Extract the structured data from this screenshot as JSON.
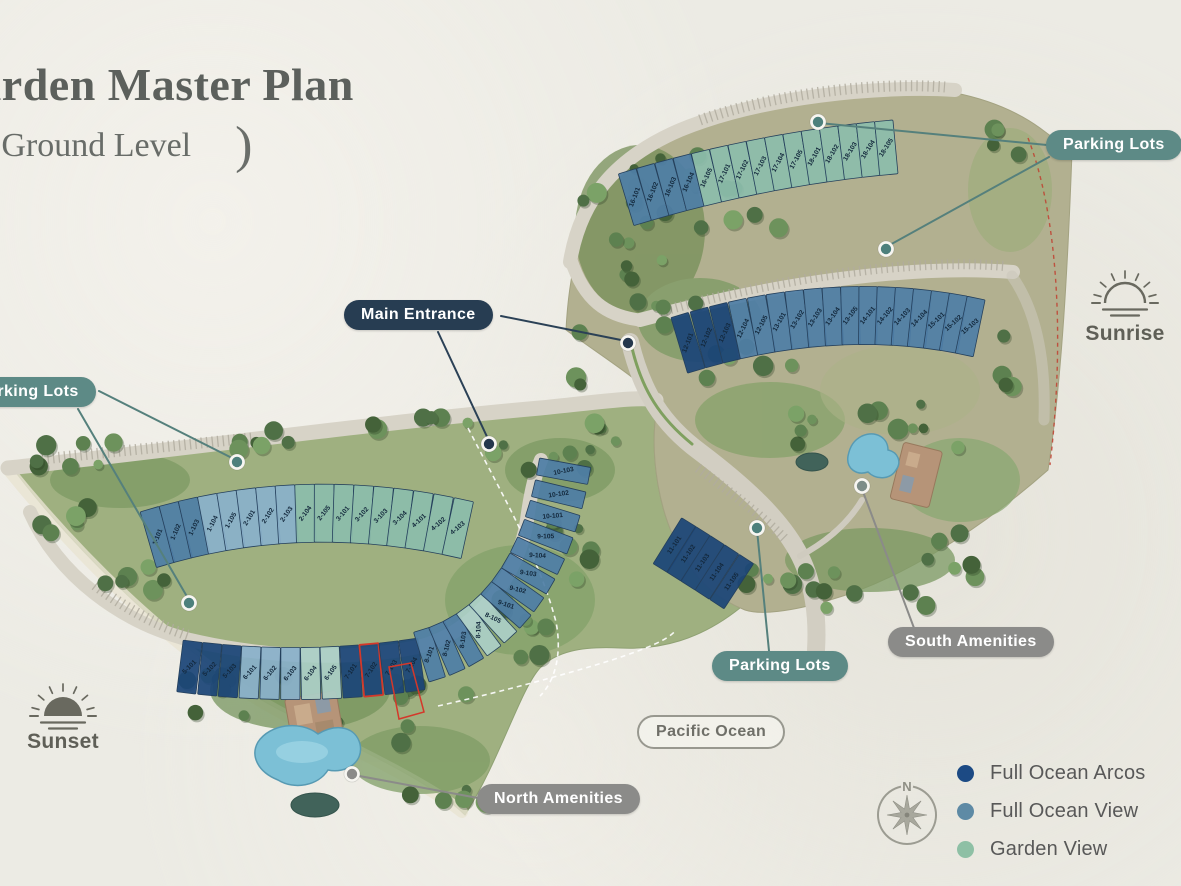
{
  "title": "Garden Master Plan",
  "subtitle": {
    "open": "(",
    "text": "Ground Level",
    "close": ")"
  },
  "callouts": {
    "main_entrance": "Main Entrance",
    "parking_lots": "Parking Lots",
    "south_amenities": "South Amenities",
    "north_amenities": "North Amenities",
    "pacific_ocean": "Pacific Ocean"
  },
  "directions": {
    "sunrise": "Sunrise",
    "sunset": "Sunset",
    "compass_north": "N"
  },
  "legend": {
    "items": [
      {
        "label": "Full Ocean Arcos",
        "category": "arcos"
      },
      {
        "label": "Full Ocean View",
        "category": "view"
      },
      {
        "label": "Garden View",
        "category": "garden"
      }
    ]
  },
  "colors": {
    "arcos": "#1b4577",
    "view": "#4f7ea6",
    "view_light": "#8ab0ca",
    "garden": "#8cbcab",
    "garden_light": "#abcfc6",
    "legend_arcos": "#1c4a84",
    "legend_view": "#5e8aa5",
    "legend_garden": "#8ec0a5",
    "pill_teal": "#5d8a86",
    "pill_navy": "#273d52",
    "pill_gray": "#8b8b89",
    "highlight": "#d4382a",
    "unit_label": "#13283c"
  },
  "highlight_unit": "7-102",
  "buildings": {
    "rowA": [
      {
        "id": "16-101",
        "category": "view"
      },
      {
        "id": "16-102",
        "category": "view"
      },
      {
        "id": "16-103",
        "category": "view"
      },
      {
        "id": "16-104",
        "category": "view"
      },
      {
        "id": "16-105",
        "category": "garden"
      },
      {
        "id": "17-101",
        "category": "garden"
      },
      {
        "id": "17-102",
        "category": "garden"
      },
      {
        "id": "17-103",
        "category": "garden"
      },
      {
        "id": "17-104",
        "category": "garden"
      },
      {
        "id": "17-105",
        "category": "garden"
      },
      {
        "id": "18-101",
        "category": "garden"
      },
      {
        "id": "18-102",
        "category": "garden"
      },
      {
        "id": "18-103",
        "category": "garden"
      },
      {
        "id": "18-104",
        "category": "garden"
      },
      {
        "id": "18-105",
        "category": "garden"
      }
    ],
    "rowB": [
      {
        "id": "12-101",
        "category": "arcos"
      },
      {
        "id": "12-102",
        "category": "arcos"
      },
      {
        "id": "12-103",
        "category": "arcos"
      },
      {
        "id": "12-104",
        "category": "view"
      },
      {
        "id": "12-105",
        "category": "view"
      },
      {
        "id": "13-101",
        "category": "view"
      },
      {
        "id": "13-102",
        "category": "view"
      },
      {
        "id": "13-103",
        "category": "view"
      },
      {
        "id": "13-104",
        "category": "view"
      },
      {
        "id": "13-105",
        "category": "view"
      },
      {
        "id": "14-101",
        "category": "view"
      },
      {
        "id": "14-102",
        "category": "view"
      },
      {
        "id": "14-103",
        "category": "view"
      },
      {
        "id": "14-104",
        "category": "view"
      },
      {
        "id": "15-101",
        "category": "view"
      },
      {
        "id": "15-102",
        "category": "view"
      },
      {
        "id": "15-103",
        "category": "view"
      }
    ],
    "rowC": [
      {
        "id": "1-101",
        "category": "view"
      },
      {
        "id": "1-102",
        "category": "view"
      },
      {
        "id": "1-103",
        "category": "view"
      },
      {
        "id": "1-104",
        "category": "view_light"
      },
      {
        "id": "1-105",
        "category": "view_light"
      },
      {
        "id": "2-101",
        "category": "view_light"
      },
      {
        "id": "2-102",
        "category": "view_light"
      },
      {
        "id": "2-103",
        "category": "view_light"
      },
      {
        "id": "2-104",
        "category": "garden"
      },
      {
        "id": "2-105",
        "category": "garden"
      },
      {
        "id": "3-101",
        "category": "garden"
      },
      {
        "id": "3-102",
        "category": "garden"
      },
      {
        "id": "3-103",
        "category": "garden"
      },
      {
        "id": "3-104",
        "category": "garden"
      },
      {
        "id": "4-101",
        "category": "garden"
      },
      {
        "id": "4-102",
        "category": "garden"
      },
      {
        "id": "4-103",
        "category": "garden"
      }
    ],
    "rowD": [
      {
        "id": "5-101",
        "category": "arcos"
      },
      {
        "id": "5-102",
        "category": "arcos"
      },
      {
        "id": "5-103",
        "category": "arcos"
      },
      {
        "id": "6-101",
        "category": "view_light"
      },
      {
        "id": "6-102",
        "category": "view_light"
      },
      {
        "id": "6-103",
        "category": "view_light"
      },
      {
        "id": "6-104",
        "category": "garden_light"
      },
      {
        "id": "6-105",
        "category": "garden_light"
      },
      {
        "id": "7-101",
        "category": "arcos"
      },
      {
        "id": "7-102",
        "category": "arcos"
      },
      {
        "id": "7-103",
        "category": "arcos"
      },
      {
        "id": "7-104",
        "category": "arcos"
      }
    ],
    "rowE": [
      {
        "id": "8-101",
        "category": "view"
      },
      {
        "id": "8-102",
        "category": "view"
      },
      {
        "id": "8-103",
        "category": "view"
      },
      {
        "id": "8-104",
        "category": "garden_light"
      },
      {
        "id": "8-105",
        "category": "garden_light"
      },
      {
        "id": "9-101",
        "category": "view"
      },
      {
        "id": "9-102",
        "category": "view"
      },
      {
        "id": "9-103",
        "category": "view"
      },
      {
        "id": "9-104",
        "category": "view"
      },
      {
        "id": "9-105",
        "category": "view"
      },
      {
        "id": "10-101",
        "category": "view"
      },
      {
        "id": "10-102",
        "category": "view"
      },
      {
        "id": "10-103",
        "category": "view"
      }
    ],
    "rowF": [
      {
        "id": "11-101",
        "category": "arcos"
      },
      {
        "id": "11-102",
        "category": "arcos"
      },
      {
        "id": "11-103",
        "category": "arcos"
      },
      {
        "id": "11-104",
        "category": "arcos"
      },
      {
        "id": "11-105",
        "category": "arcos"
      }
    ]
  }
}
